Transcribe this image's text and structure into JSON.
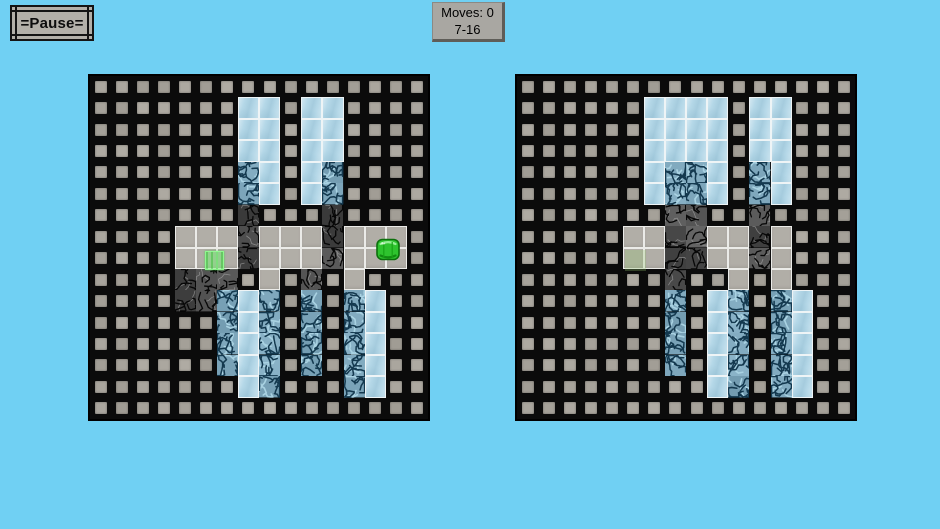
{
  "hud": {
    "pause_label": "=Pause=",
    "moves_label": "Moves: 0",
    "level_label": "7-16"
  },
  "legend": {
    "W": "wall",
    "F": "floor",
    "I": "ice",
    "C": "cracked-ice",
    "R": "cracked-rock"
  },
  "colors": {
    "background": "#70d0f3",
    "wall_bg": "#0b0b0b",
    "wall_brick": "#a8a49c",
    "floor": "#b1aea7",
    "ice": "#b5d8e8",
    "cracked_ice_base": "#7fa9bf",
    "cracked_ice_crack": "#14394f",
    "rock_base": "#575757",
    "rock_crack": "#070707",
    "gem_green": "#2ec32e",
    "goal_green": "#3ad63a",
    "panel_gray": "#a9a7a2",
    "button_gray": "#b3b0a9"
  },
  "boards": [
    {
      "name": "left",
      "grid": [
        "WWWWWWWWWWWWWWWW",
        "WWWWWWWIIWIIWWWW",
        "WWWWWWWIIWIIWWWW",
        "WWWWWWWIIWIIWWWW",
        "WWWWWWWCIWICWWWW",
        "WWWWWWWCIWICWWWW",
        "WWWWWWWRWWWRWWWW",
        "WWWWFFFRFFFRFFFW",
        "WWWWFFFRFFFRFFFW",
        "WWWWRRRWFWRWFWWW",
        "WWWWRRCICWCWCIWW",
        "WWWWWWCICWCWCIWW",
        "WWWWWWCICWCWCIWW",
        "WWWWWWCICWCWCIWW",
        "WWWWWWWICWWWCIWW",
        "WWWWWWWWWWWWWWWW"
      ],
      "pieces": [
        {
          "type": "gem",
          "row": 7.5,
          "col": 13.5
        },
        {
          "type": "goal",
          "row": 8,
          "col": 5.3
        }
      ]
    },
    {
      "name": "right",
      "grid": [
        "WWWWWWWWWWWWWWWW",
        "WWWWWWIIIIWIIWWW",
        "WWWWWWIIIIWIIWWW",
        "WWWWWWIIIIWIIWWW",
        "WWWWWWICCIWCIWWW",
        "WWWWWWICCIWCIWWW",
        "WWWWWWWRRWWRWWWW",
        "WWWWWFFRRFFRFWWW",
        "WWWWWFFRRFFRFWWW",
        "WWWWWWWRWWFWFWWW",
        "WWWWWWWCWICWCIWW",
        "WWWWWWWCWICWCIWW",
        "WWWWWWWCWICWCIWW",
        "WWWWWWWCWICWCIWW",
        "WWWWWWWWWICWCIWW",
        "WWWWWWWWWWWWWWWW"
      ],
      "pieces": [
        {
          "type": "goal-faint",
          "row": 8,
          "col": 5
        }
      ]
    }
  ]
}
